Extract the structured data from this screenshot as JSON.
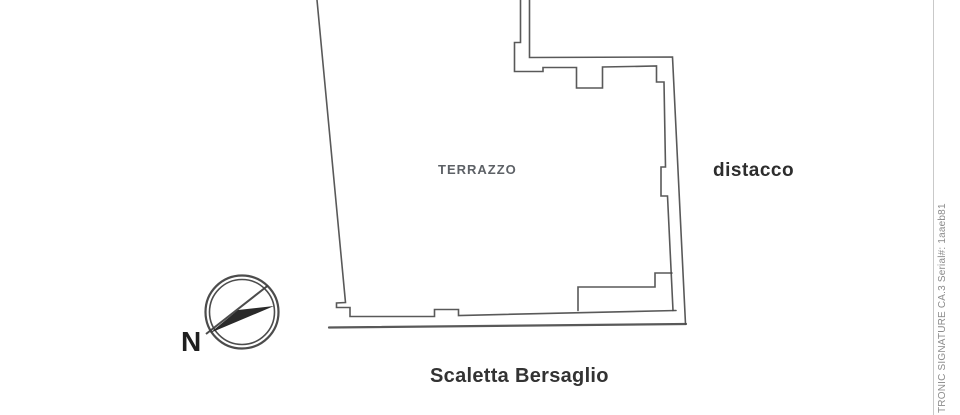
{
  "page": {
    "background": "#ffffff",
    "ink_color": "#474747",
    "divider_color": "#c9c9c9"
  },
  "plan": {
    "area_label": "TERRAZZO",
    "right_label": "distacco",
    "bottom_label": "Scaletta Bersaglio"
  },
  "compass": {
    "north_label": "N"
  },
  "signature_strip": {
    "text": "TRONIC SIGNATURE CA.3 Serial#: 1aaeb81"
  }
}
